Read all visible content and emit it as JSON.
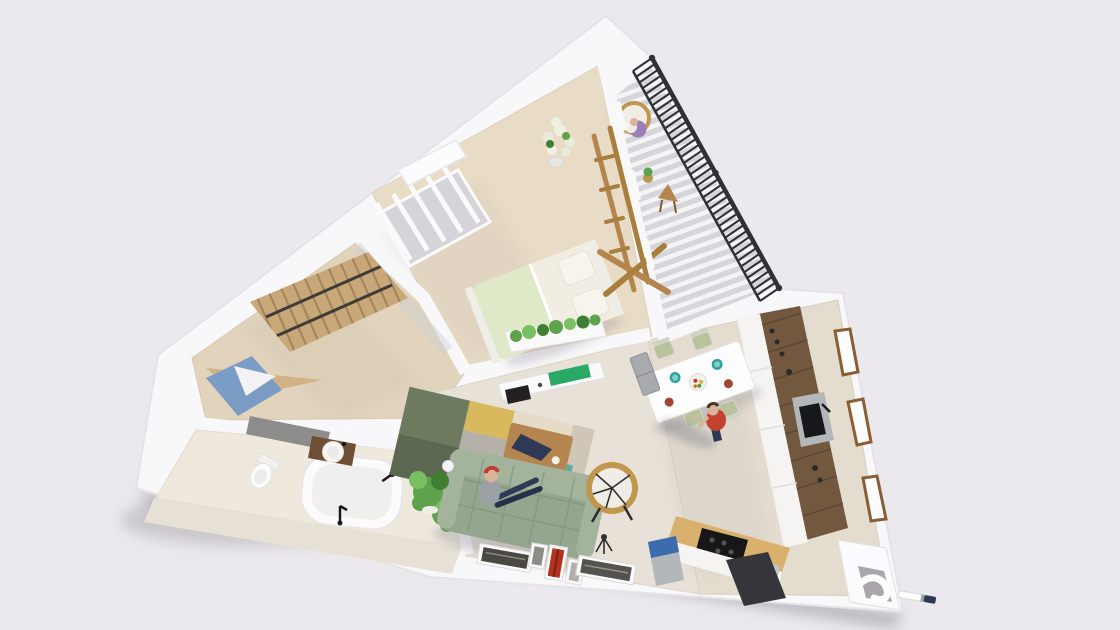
{
  "scene": {
    "name": "3d-apartment-floor-plan-render",
    "view": "top-down-cutaway",
    "background": "#ebe9ed"
  },
  "palette": {
    "background": "#ebe9ed",
    "footprint": "#f8f7f9",
    "wall_shade": "#e2e0e4",
    "floor_bedroom": "#e9dcc6",
    "floor_hall": "#e2d4bc",
    "floor_bath": "#efe8dd",
    "floor_living": "#e7e1d7",
    "floor_kitchen": "#e3dccf",
    "deck_base": "#d6d6da",
    "deck_stripe": "#f4f4f6",
    "railing": "#2e3137",
    "wood": "#c8a779",
    "wood_light": "#d2b285",
    "wood_dark": "#8a5e33",
    "pergola": "#b5854f",
    "counter_wood": "#72583f",
    "worktop": "#d9b06c",
    "bed_white": "#f2ede3",
    "blanket_green": "#dfe9c8",
    "sofa_green": "#95a68f",
    "sofa_dark": "#7f9078",
    "sofa_light": "#a3b39c",
    "rug_olive": "#6d7a5f",
    "rug_mustard": "#d8b95e",
    "rug_teal": "#59b0a2",
    "rug_beige": "#e6dbc5",
    "rug_gray": "#b5b0a8",
    "accent_green": "#2aa866",
    "accent_red": "#b5321f",
    "plant_green": "#5fa24c",
    "plant_dark": "#3e7f31",
    "plant_light": "#79c063",
    "blue_rug": "#7b9cc4",
    "blue_dark": "#3c6cae",
    "steel": "#b3b7ba",
    "dark": "#23211f",
    "skin": "#d9b49a",
    "purple": "#9a7fb5",
    "rattan": "#c0974f",
    "shadow": "#8d8a93",
    "white": "#fbfafb",
    "tile": "#e7e0d5",
    "vanity_wood": "#6e4f35",
    "red_shirt": "#c4402f",
    "navy": "#2e3a55"
  },
  "counts": {
    "railing_balusters": 40,
    "deck_stripes": 26,
    "wardrobe_slats": 11,
    "window_mullions": 5,
    "plank_lines": 9
  },
  "rooms": {
    "bedroom": {
      "name": "bedroom",
      "items": [
        "double-bed",
        "green-blanket",
        "pillows",
        "planter-row",
        "flower-plant",
        "pergola-frame",
        "window",
        "radiator",
        "bench"
      ]
    },
    "balcony": {
      "name": "balcony",
      "items": [
        "railing",
        "deck-boards",
        "hanging-chair",
        "side-table",
        "potted-plant"
      ]
    },
    "wardrobe_hall": {
      "name": "wardrobe-hallway",
      "items": [
        "open-wardrobe",
        "desk-nook",
        "blue-rug",
        "gray-sideboard",
        "glass-partition"
      ]
    },
    "bathroom": {
      "name": "bathroom",
      "items": [
        "bathtub",
        "freestanding-faucet",
        "towel-rail",
        "toilet",
        "vanity-basin",
        "plant",
        "laundry-bag",
        "door"
      ]
    },
    "living_room": {
      "name": "living-room",
      "items": [
        "sofa",
        "person-sitting",
        "patchwork-rug",
        "coffee-table",
        "tv-sideboard",
        "rattan-ring-chair",
        "floor-art-row",
        "plant",
        "sphere-lamp",
        "tripod-stool"
      ]
    },
    "kitchen_dining": {
      "name": "kitchen-dining",
      "items": [
        "dining-table",
        "plates",
        "chairs",
        "fridge-cabinet",
        "person-walking",
        "counter-strip",
        "sink-unit",
        "cooktop",
        "worktop",
        "blue-fridge",
        "dishwasher",
        "windows",
        "door-mat"
      ]
    },
    "entrance": {
      "name": "entrance",
      "items": [
        "door-frame",
        "door-handle",
        "marker-object"
      ]
    }
  }
}
